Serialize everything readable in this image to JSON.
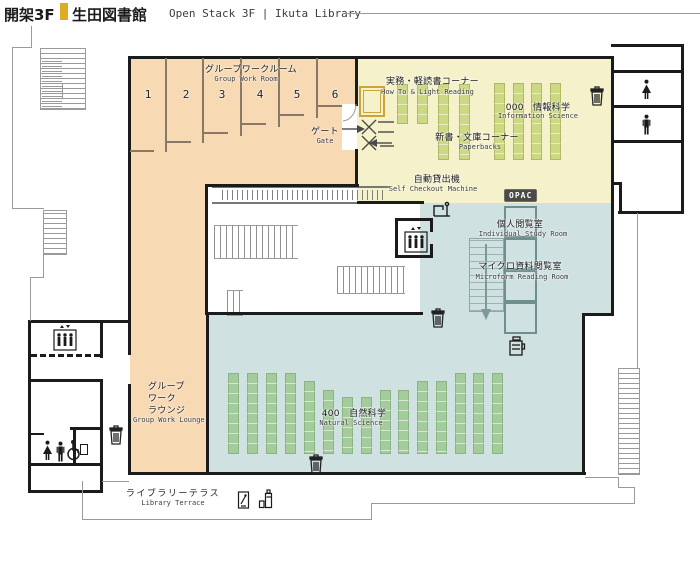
{
  "header": {
    "floor": "開架3F",
    "library": "生田図書館",
    "subtitle": "Open Stack 3F | Ikuta Library"
  },
  "labels": {
    "group_work_room": {
      "jp": "グループワークルーム",
      "en": "Group Work Room"
    },
    "room_numbers": [
      "1",
      "2",
      "3",
      "4",
      "5",
      "6"
    ],
    "gate": {
      "jp": "ゲート",
      "en": "Gate"
    },
    "how_to_light_reading": {
      "jp": "実務・軽読書コーナー",
      "en": "How To & Light Reading"
    },
    "information_science": {
      "jp": "000　情報科学",
      "en": "Information Science"
    },
    "paperbacks": {
      "jp": "新書・文庫コーナー",
      "en": "Paperbacks"
    },
    "self_checkout": {
      "jp": "自動貸出機",
      "en": "Self Checkout Machine"
    },
    "opac": "OPAC",
    "individual_study": {
      "jp": "個人閲覧室",
      "en": "Individual Study Room"
    },
    "microform": {
      "jp": "マイクロ資料閲覧室",
      "en": "Microform Reading Room"
    },
    "natural_science": {
      "jp": "400　自然科学",
      "en": "Natural Science"
    },
    "group_work_lounge": {
      "jp1": "グループ",
      "jp2": "ワーク",
      "jp3": "ラウンジ",
      "en": "Group Work Lounge"
    },
    "library_terrace": {
      "jp": "ライブラリーテラス",
      "en": "Library Terrace"
    }
  },
  "colors": {
    "accent": "#e2ab24",
    "group_work_area": "#f7d9b4",
    "reading_corner_area": "#f5f2cb",
    "stacks_area": "#cfe1e1",
    "shelf_green": "#a3cb9c",
    "shelf_olive": "#ccd883",
    "wall": "#1b1b1b"
  },
  "shelves": {
    "olive": [
      [
        397,
        84,
        38
      ],
      [
        417,
        84,
        38
      ],
      [
        438,
        84,
        74
      ],
      [
        459,
        84,
        74
      ],
      [
        494,
        83,
        75
      ],
      [
        513,
        83,
        75
      ],
      [
        531,
        83,
        75
      ],
      [
        550,
        83,
        75
      ]
    ],
    "green": [
      [
        228,
        373,
        79
      ],
      [
        247,
        373,
        79
      ],
      [
        266,
        373,
        79
      ],
      [
        285,
        373,
        79
      ],
      [
        304,
        381,
        71
      ],
      [
        323,
        390,
        62
      ],
      [
        342,
        397,
        55
      ],
      [
        361,
        397,
        55
      ],
      [
        380,
        390,
        62
      ],
      [
        398,
        390,
        62
      ],
      [
        417,
        381,
        71
      ],
      [
        436,
        381,
        71
      ],
      [
        455,
        373,
        79
      ],
      [
        473,
        373,
        79
      ],
      [
        492,
        373,
        79
      ]
    ]
  }
}
